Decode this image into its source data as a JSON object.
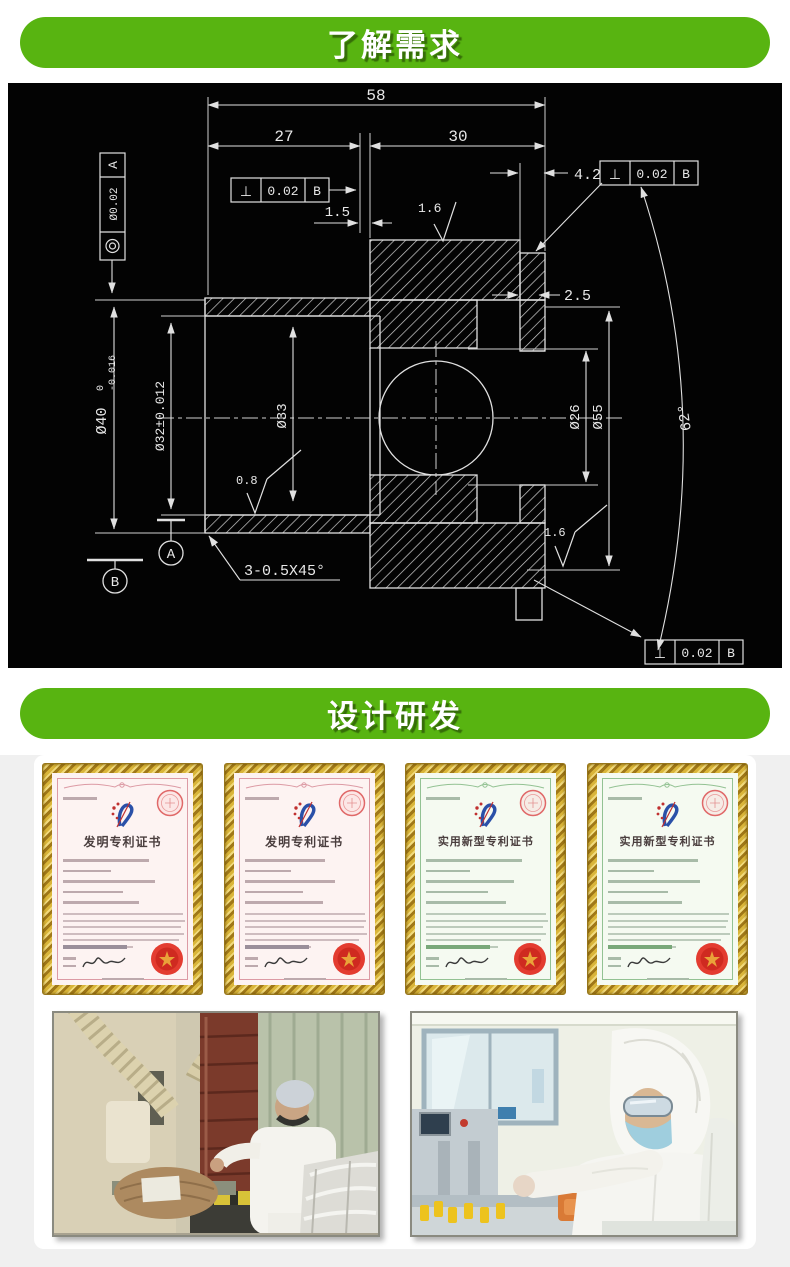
{
  "banners": [
    {
      "label": "了解需求",
      "color": "#58b411"
    },
    {
      "label": "设计研发",
      "color": "#58b411"
    }
  ],
  "drawing": {
    "background": "#030303",
    "line_color": "#e0e0e0",
    "dimensions": {
      "width_total": "58",
      "width_left": "27",
      "width_right": "30",
      "lip_width": "4.2",
      "step": "1.5",
      "wall": "2.5",
      "od_flange": {
        "text": "Ø40",
        "tol_upper": "0",
        "tol_lower": "-0.016"
      },
      "bore_flange": "Ø32±0.012",
      "bore_body": "Ø33",
      "bore_right": "Ø26",
      "od_body": "Ø55",
      "cone_angle": "62°",
      "chamfer": "3-0.5X45°",
      "roughness_top": "1.6",
      "roughness_bore": "0.8",
      "roughness_bottom": "1.6"
    },
    "gdt": {
      "perpendicularity_symbol": "⊥",
      "frame_top_left": {
        "tol": "0.02",
        "datum": "B"
      },
      "frame_top_right": {
        "tol": "0.02",
        "datum": "B"
      },
      "frame_bottom": {
        "tol": "0.02",
        "datum": "B"
      },
      "concentricity": {
        "tol": "Ø0.02",
        "datum": "A"
      },
      "datum_a": "A",
      "datum_b": "B"
    }
  },
  "certificates": [
    {
      "title": "发明专利证书",
      "tint": "pink"
    },
    {
      "title": "发明专利证书",
      "tint": "pink"
    },
    {
      "title": "实用新型专利证书",
      "tint": "green"
    },
    {
      "title": "实用新型专利证书",
      "tint": "green"
    }
  ]
}
